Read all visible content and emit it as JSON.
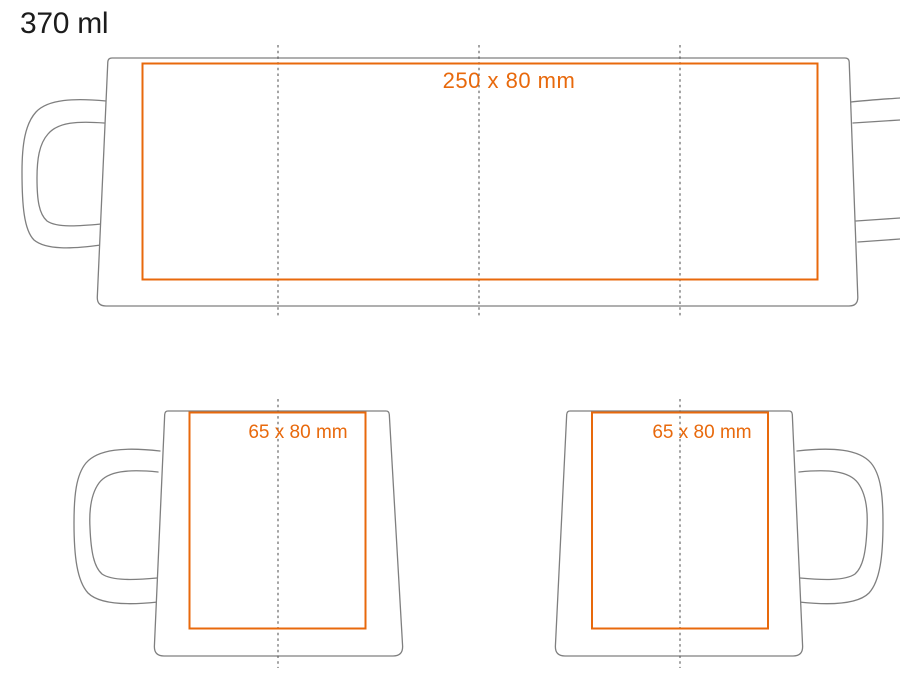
{
  "title": "370 ml",
  "colors": {
    "accent": "#e8690c",
    "outline": "#7f7f7f",
    "dash": "#5a5a5a",
    "title_text": "#1c1c1c"
  },
  "views": {
    "wrap": {
      "print_area_label": "250 x 80 mm"
    },
    "front": {
      "print_area_label": "65 x 80 mm"
    },
    "back": {
      "print_area_label": "65 x 80 mm"
    }
  }
}
